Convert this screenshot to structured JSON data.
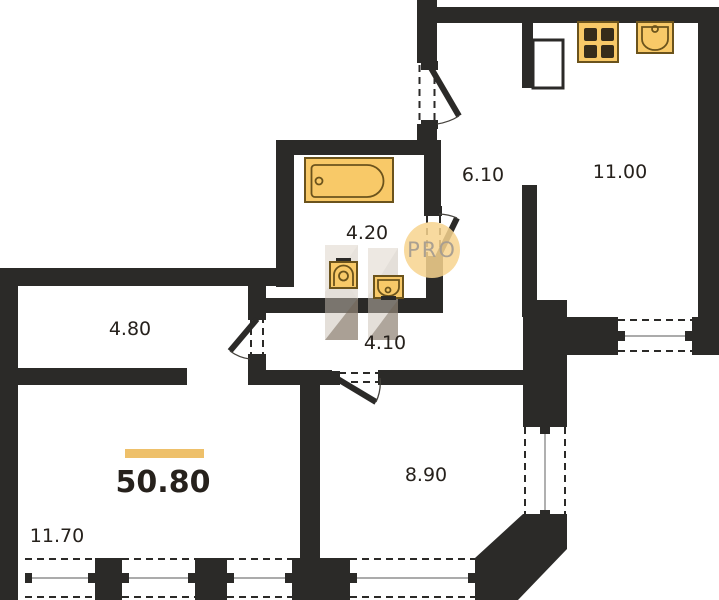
{
  "floor_plan": {
    "total_area": "50.80",
    "watermark": "PRO",
    "room_areas": {
      "entry_hall": "6.10",
      "kitchen": "11.00",
      "bathroom": "4.20",
      "inner_hall": "4.10",
      "corridor": "4.80",
      "living_room": "11.70",
      "bedroom": "8.90"
    },
    "colors": {
      "wall": "#2b2a28",
      "fixture_fill": "#f8c968",
      "fixture_stroke": "#6b531c",
      "accent_bar": "#eec06a",
      "watermark_fill": "#f7d48e",
      "watermark_text": "#a69d91",
      "label": "#26211c"
    }
  }
}
